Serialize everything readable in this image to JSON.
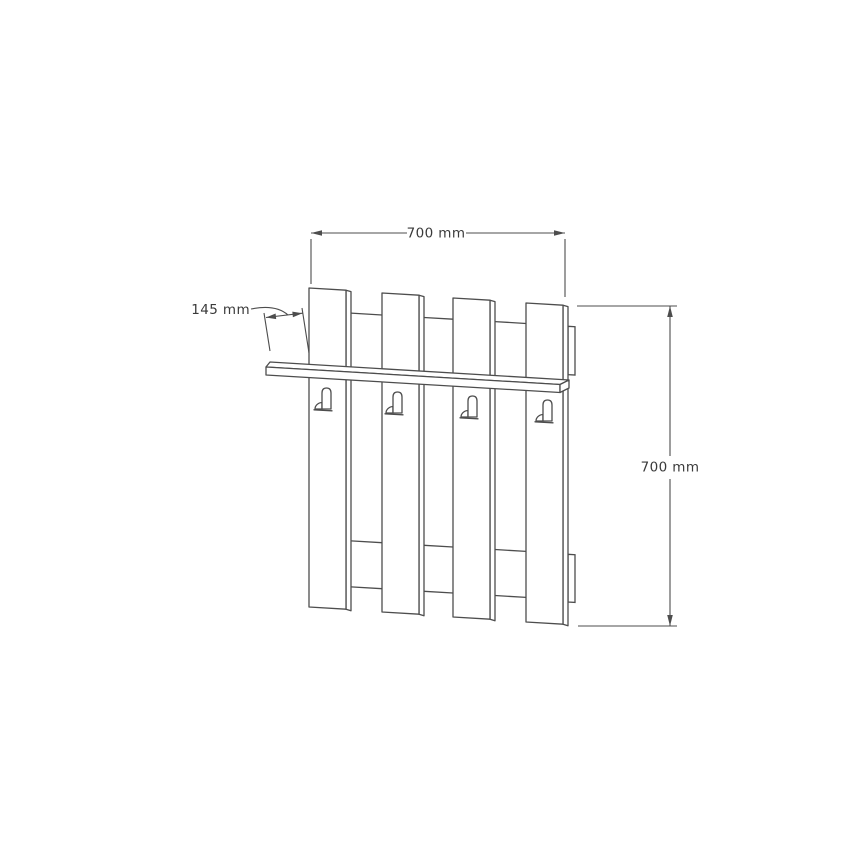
{
  "page": {
    "background_color": "#ffffff",
    "line_color": "#4d4d4d",
    "text_color": "#3a3a3a"
  },
  "drawing": {
    "kind": "technical-dimension-drawing",
    "subject": "wall-mounted coat rack with shelf, four slats and four hooks",
    "slat_count": 4,
    "hook_count": 4
  },
  "dimensions": {
    "width": {
      "label": "700 mm",
      "value": 700,
      "unit": "mm"
    },
    "height": {
      "label": "700 mm",
      "value": 700,
      "unit": "mm"
    },
    "depth": {
      "label": "145 mm",
      "value": 145,
      "unit": "mm"
    }
  }
}
